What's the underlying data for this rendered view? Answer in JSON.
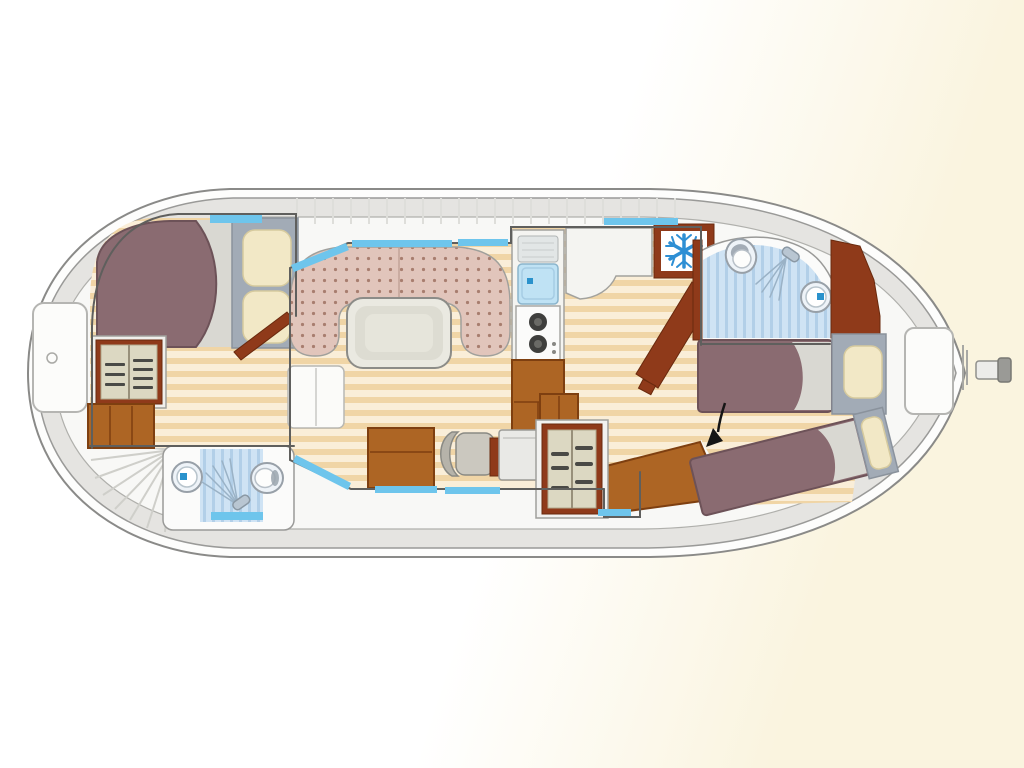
{
  "description": "Top-view interior floor plan of a canal houseboat (no text labels in drawing)",
  "palette": {
    "background_tint": "#faf4df",
    "hull_outline": "#8a8a88",
    "hull_band": "#e5e4e1",
    "hull_white": "#fdfdfc",
    "deck": "#f8f8f6",
    "wall_line": "#5f5f5d",
    "wood_light": "#faeed8",
    "wood_dark": "#f0d5a6",
    "window_blue": "#6ec5ec",
    "bath_floor": "#cfe3f4",
    "bath_stripe": "#b2cfe8",
    "bed_mauve": "#8a6b71",
    "bed_edge": "#6d5258",
    "blanket": "#d9d8d2",
    "headboard": "#a2abb6",
    "pillow": "#f2e8c6",
    "pillow_edge": "#d6ca9e",
    "dinette": "#e1c5bb",
    "dinette_dot": "#a87e6f",
    "table_top": "#eae9e1",
    "wood_brown": "#ad6524",
    "wood_brown_dark": "#7e3f10",
    "door_brown": "#8f3a1a",
    "shelf_cream": "#dcd8c2",
    "counter": "#f4f4f1",
    "sink_blue": "#bfe2f4",
    "water_dot": "#2a92cc",
    "burner": "#3f3f3d",
    "fridge_blue": "#2e8fd4",
    "fixture_fill": "#eef3f8",
    "fixture_line": "#98a0a8",
    "stair_line": "#cfcfca",
    "roof_line": "#dededa",
    "arrow": "#151515",
    "chair_gray": "#cbc8bf",
    "steel_gray": "#9a9a96"
  },
  "icons": {
    "fridge_icon": "snowflake",
    "shower_icon": "spray-head-fan",
    "toilet_icon": "oval-bowl",
    "sink_icon": "round-basin-with-water-dot",
    "stove_icon": "two-burner-hob",
    "direction_arrow_icon": "curved-black-arrow-down-left"
  }
}
